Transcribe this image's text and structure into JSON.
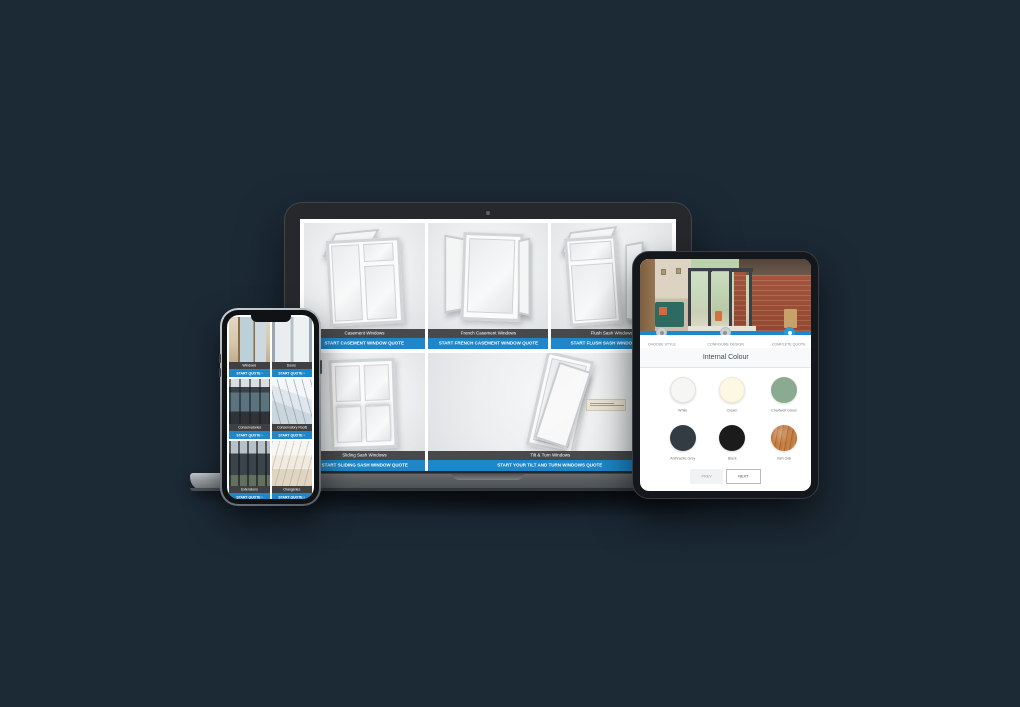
{
  "scene": {
    "background_color": "#1c2a36",
    "accent_blue": "#1d87c9"
  },
  "laptop": {
    "colors": {
      "label_bar": "#48494b",
      "cta_bar": "#1d87c9"
    },
    "products": [
      {
        "name": "Casement Windows",
        "cta": "START CASEMENT WINDOW QUOTE"
      },
      {
        "name": "French Casement Windows",
        "cta": "START FRENCH CASEMENT WINDOW QUOTE"
      },
      {
        "name": "Flush Sash Windows",
        "cta": "START FLUSH SASH WINDOW QUOTE"
      },
      {
        "name": "Sliding Sash Windows",
        "cta": "START SLIDING SASH WINDOW QUOTE"
      },
      {
        "name": "Tilt & Turn Windows",
        "cta": "START YOUR TILT AND TURN WINDOWS QUOTE"
      }
    ]
  },
  "phone": {
    "cards": [
      {
        "name": "Windows",
        "cta": "START QUOTE ›",
        "photo_css": "background:linear-gradient(90deg,rgba(0,0,0,0) 0 22%,#8d6b44 22% 27%,#bcd0da 27% 60%,#8d6b44 60% 64%,#cdd9df 64% 90%,rgba(0,0,0,0) 90%),linear-gradient(180deg,#e3d8c4 0%,#d5c6ab 60%,#bfae8e 100%)"
      },
      {
        "name": "Doors",
        "cta": "START QUOTE ›",
        "photo_css": "background:linear-gradient(90deg,#9aa7ae 0 8%,#e9edef 8% 46%,#b7c2c8 46% 54%,#eef1f2 54% 92%,#9aa7ae 92%),linear-gradient(180deg,#cfd8dc,#aebbc2)"
      },
      {
        "name": "Conservatories",
        "cta": "START QUOTE ›",
        "photo_css": "background:repeating-linear-gradient(90deg,rgba(22,27,32,.55) 0 2px,rgba(0,0,0,0) 2px 10px),linear-gradient(180deg,#d8dee1 0 18%,#3a4248 18% 30%,#5a737d 30% 72%,#2e3338 72%)"
      },
      {
        "name": "Conservatory Roofs",
        "cta": "START QUOTE ›",
        "photo_css": "background:repeating-linear-gradient(75deg,rgba(120,135,148,.5) 0 1px,rgba(0,0,0,0) 1px 8px),linear-gradient(200deg,#f4f7f9 0 35%,#dfe7ec 35% 60%,#c9d6dd 60%)"
      },
      {
        "name": "Extensions",
        "cta": "START QUOTE ›",
        "photo_css": "background:repeating-linear-gradient(90deg,rgba(18,22,26,.6) 0 2px,rgba(0,0,0,0) 2px 9px),linear-gradient(180deg,#b6c2c8 0 28%,#3c444b 28% 76%,#64705f 76%)"
      },
      {
        "name": "Orangeries",
        "cta": "START QUOTE ›",
        "photo_css": "background:repeating-linear-gradient(105deg,rgba(150,140,120,.35) 0 1px,rgba(0,0,0,0) 1px 7px),linear-gradient(180deg,#f8f6f2 0 32%,#f0eadf 32% 62%,#e0d4c2 62%)"
      }
    ]
  },
  "tablet": {
    "steps": [
      {
        "label": "CHOOSE STYLE"
      },
      {
        "label": "CONFIGURE DESIGN"
      },
      {
        "label": "COMPLETE QUOTE"
      }
    ],
    "active_step": "COMPLETE QUOTE",
    "title": "Internal Colour",
    "swatches": [
      {
        "name": "White",
        "color": "#f6f6f4",
        "css": "background:#f6f6f4;border:1px solid #e3e3e1"
      },
      {
        "name": "Cream",
        "color": "#fcf8e4",
        "css": "background:#fcf8e4;border:1px solid #efead2"
      },
      {
        "name": "Chartwell Green",
        "color": "#8bab90",
        "css": "background:#8bab90"
      },
      {
        "name": "Anthracite Grey",
        "color": "#343c43",
        "css": "background:#343c43"
      },
      {
        "name": "Black",
        "color": "#1b1b1b",
        "css": "background:#1b1b1b"
      },
      {
        "name": "Irish Oak",
        "color": "#bc7840",
        "css": "background:radial-gradient(circle at 35% 30%,rgba(255,255,255,.28),rgba(0,0,0,0) 45%),repeating-linear-gradient(100deg,#c8834a 0 2px,#a9682f 2px 3px,#c07c42 3px 5px),#bc7840"
      }
    ],
    "prev_label": "PREV",
    "next_label": "NEXT"
  }
}
